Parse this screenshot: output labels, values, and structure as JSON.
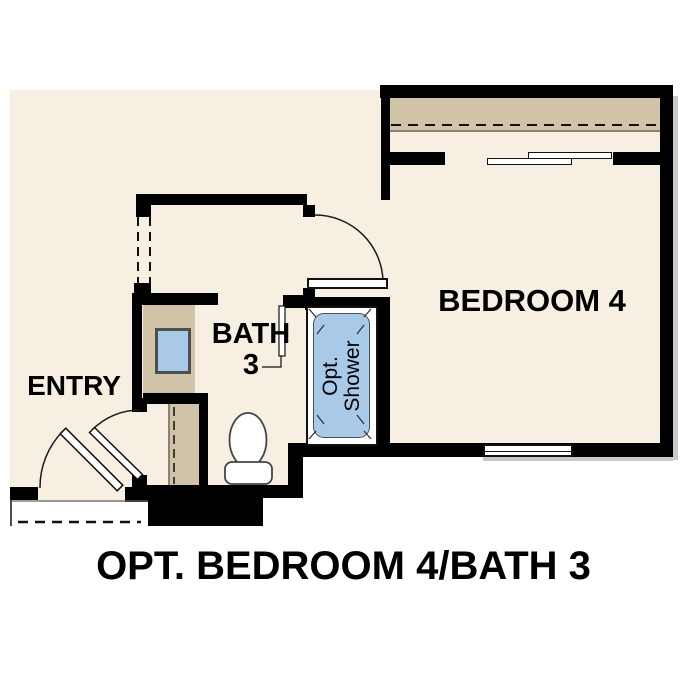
{
  "title": "OPT. BEDROOM 4/BATH 3",
  "rooms": {
    "bedroom": {
      "label": "BEDROOM 4"
    },
    "bath": {
      "label_line1": "BATH",
      "label_line2": "3"
    },
    "entry": {
      "label": "ENTRY"
    },
    "shower": {
      "label_line1": "Opt.",
      "label_line2": "Shower"
    }
  },
  "fixtures": {
    "toilet": "toilet",
    "sink": "vanity-sink",
    "shower": "optional-shower-stall",
    "closet_doors": "bypass-closet-doors",
    "window": "bedroom-window",
    "entry_door": "entry-swing-door",
    "hall_door": "interior-swing-door",
    "bedroom_door": "bedroom-swing-door",
    "bath_door": "bath-door-leaf",
    "stoop": "entry-stoop"
  },
  "colors": {
    "floor_beige": "#f7efe2",
    "closet_tan": "#d1c3a8",
    "fixture_blue": "#a9c9e9",
    "wall_black": "#000000",
    "shadow_gray": "#9a9a9a",
    "text_black": "#000000",
    "background_white": "#ffffff"
  }
}
